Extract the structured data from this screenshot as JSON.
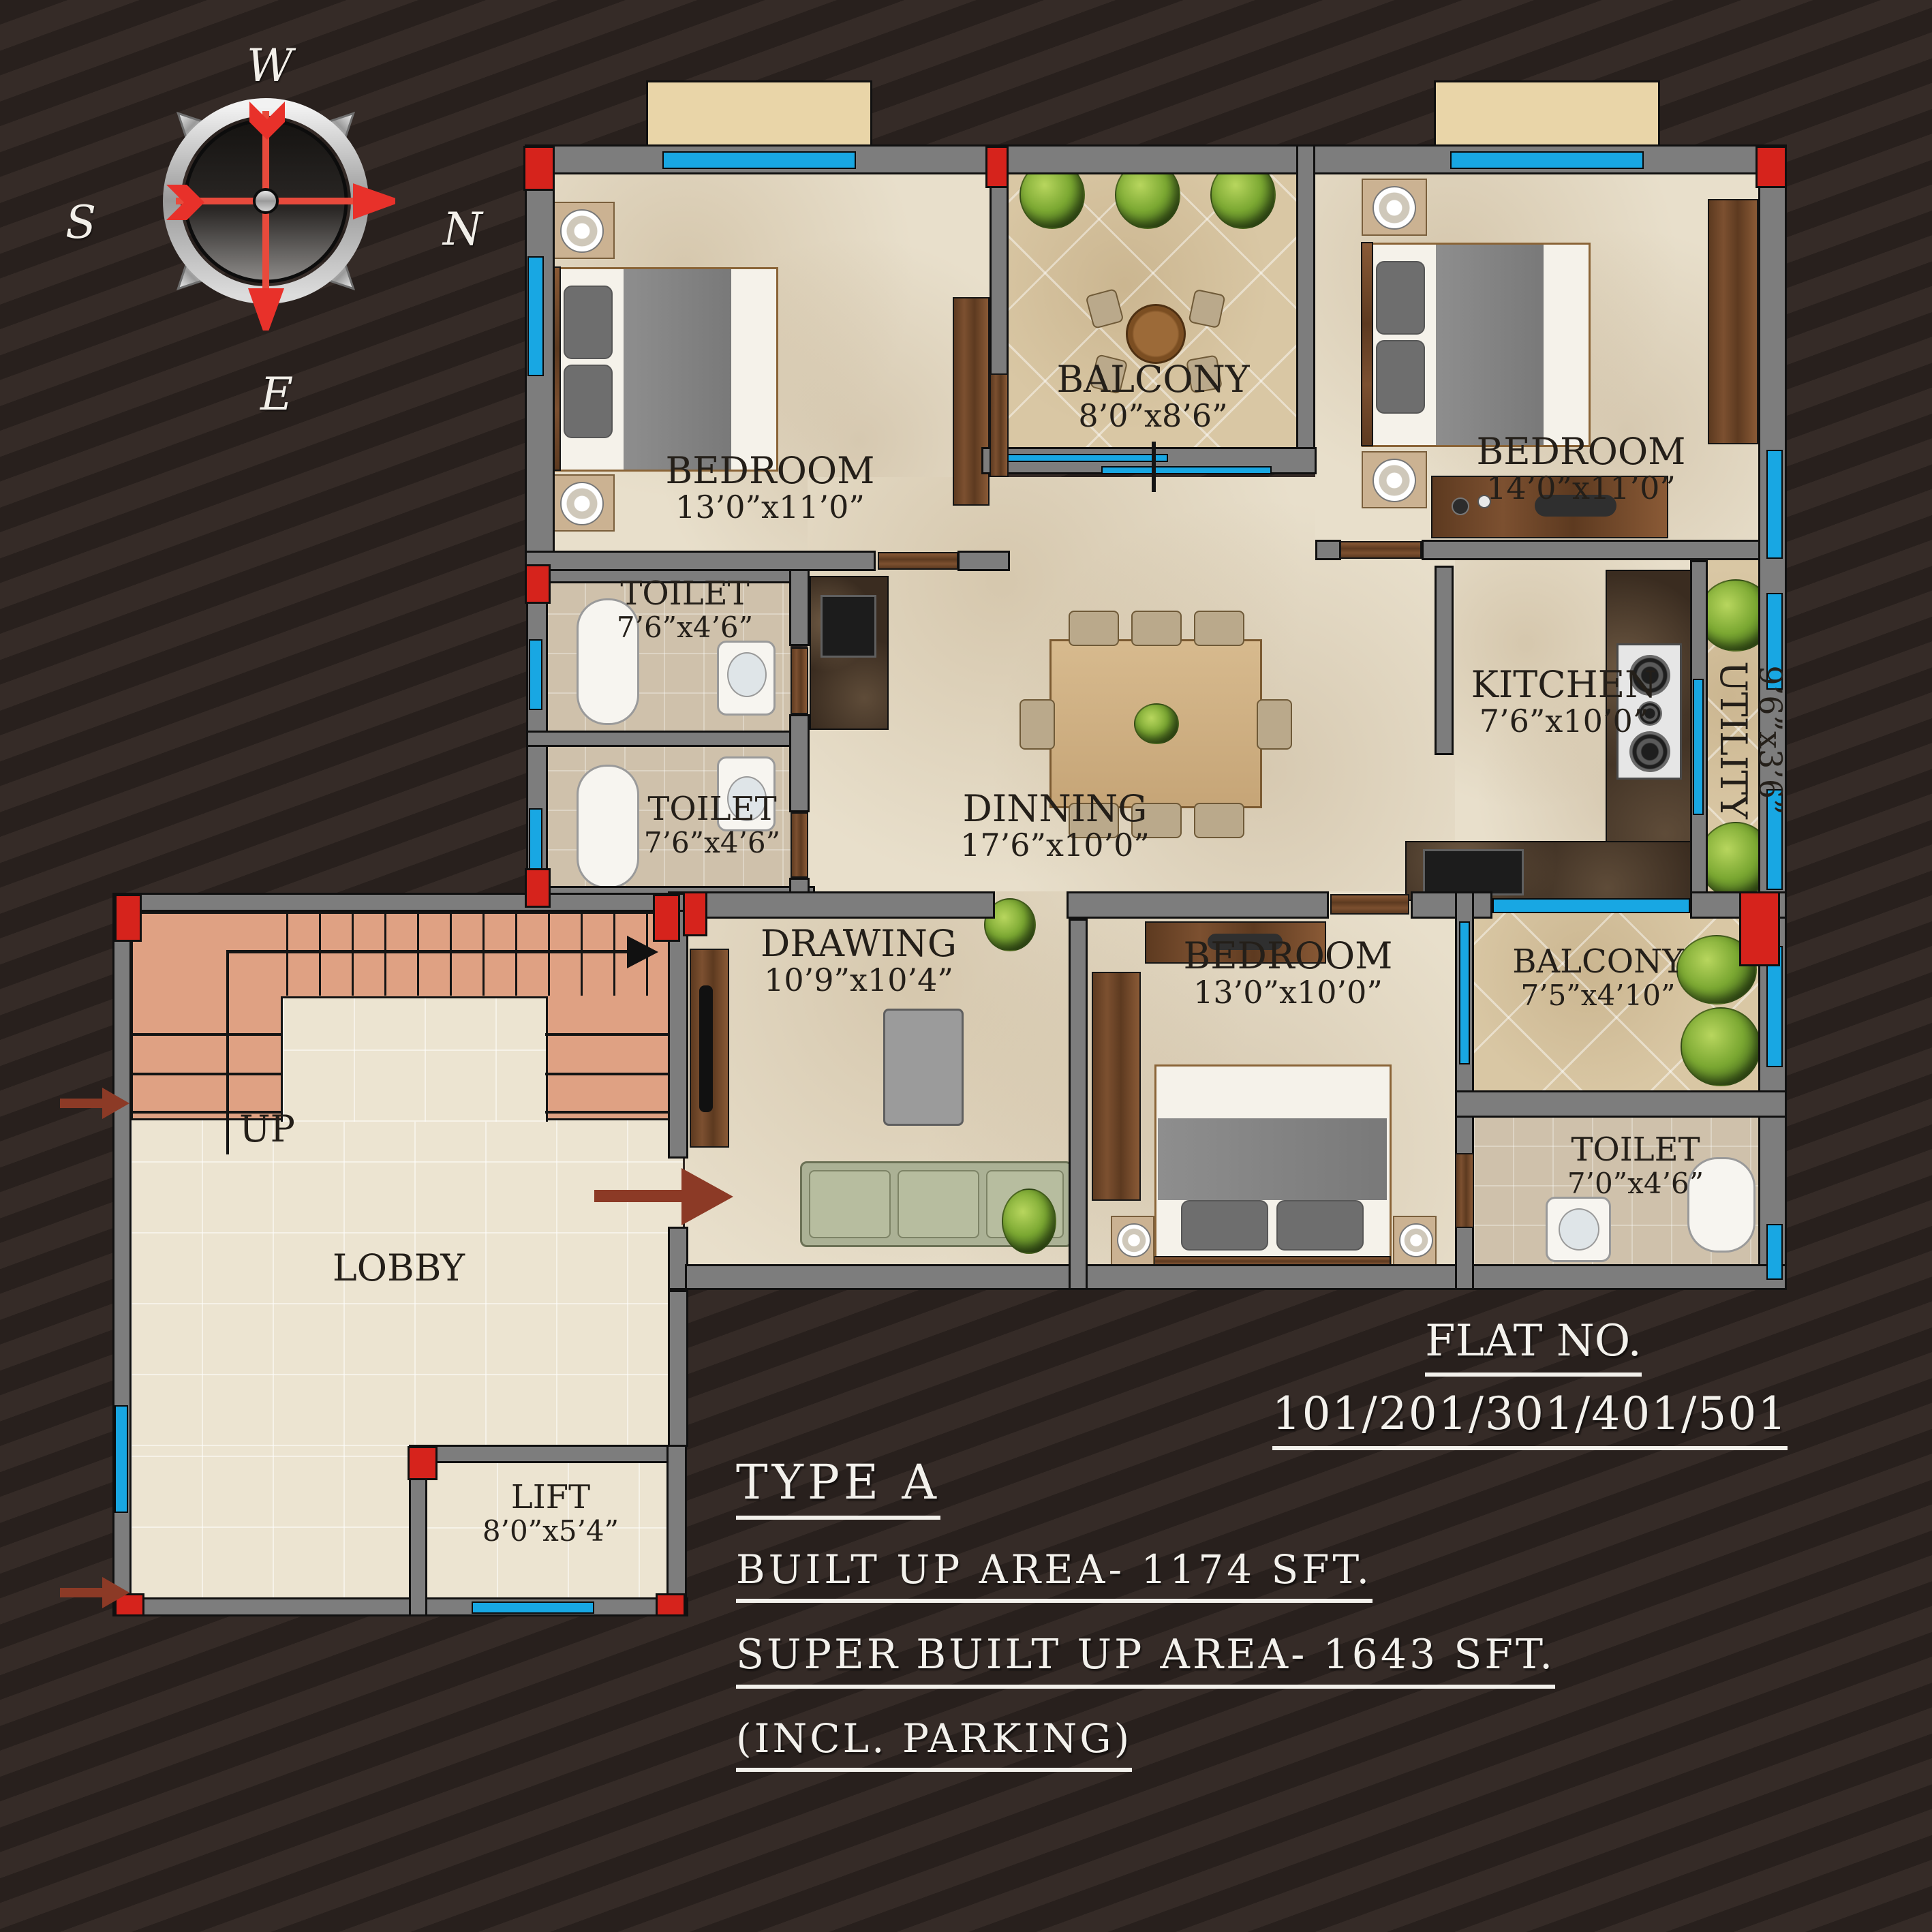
{
  "compass": {
    "west": "W",
    "south": "S",
    "north": "N",
    "east": "E"
  },
  "rooms": {
    "bedroom1": {
      "name": "BEDROOM",
      "dims": "13’0”x11’0”"
    },
    "balcony1": {
      "name": "BALCONY",
      "dims": "8’0”x8’6”"
    },
    "bedroom2": {
      "name": "BEDROOM",
      "dims": "14’0”x11’0”"
    },
    "toilet1": {
      "name": "TOILET",
      "dims": "7’6”x4’6”"
    },
    "toilet2": {
      "name": "TOILET",
      "dims": "7’6”x4’6”"
    },
    "dinning": {
      "name": "DINNING",
      "dims": "17’6”x10’0”"
    },
    "kitchen": {
      "name": "KITCHEN",
      "dims": "7’6”x10’0”"
    },
    "utility": {
      "name": "UTILITY",
      "dims": "9’6”x3’6”"
    },
    "drawing": {
      "name": "DRAWING",
      "dims": "10’9”x10’4”"
    },
    "bedroom3": {
      "name": "BEDROOM",
      "dims": "13’0”x10’0”"
    },
    "balcony2": {
      "name": "BALCONY",
      "dims": "7’5”x4’10”"
    },
    "toilet3": {
      "name": "TOILET",
      "dims": "7’0”x4’6”"
    },
    "stairs": {
      "up": "UP"
    },
    "lobby": {
      "name": "LOBBY"
    },
    "lift": {
      "name": "LIFT",
      "dims": "8’0”x5’4”"
    }
  },
  "info": {
    "flat_no_label": "FLAT NO.",
    "flat_numbers": "101/201/301/401/501",
    "type_label": "TYPE A",
    "built_up": "BUILT UP AREA- 1174 SFT.",
    "super_built_up": "SUPER BUILT UP AREA- 1643 SFT.",
    "parking_note": "(INCL. PARKING)"
  },
  "colors": {
    "background": "#322824",
    "wall_gray": "#7d7d7d",
    "accent_red": "#d6231c",
    "window_blue": "#18a7e3",
    "floor_beige": "#e8dfcb",
    "stair_salmon": "#dfa183",
    "text_dark": "#241f19",
    "text_light": "#f3f1ec"
  }
}
